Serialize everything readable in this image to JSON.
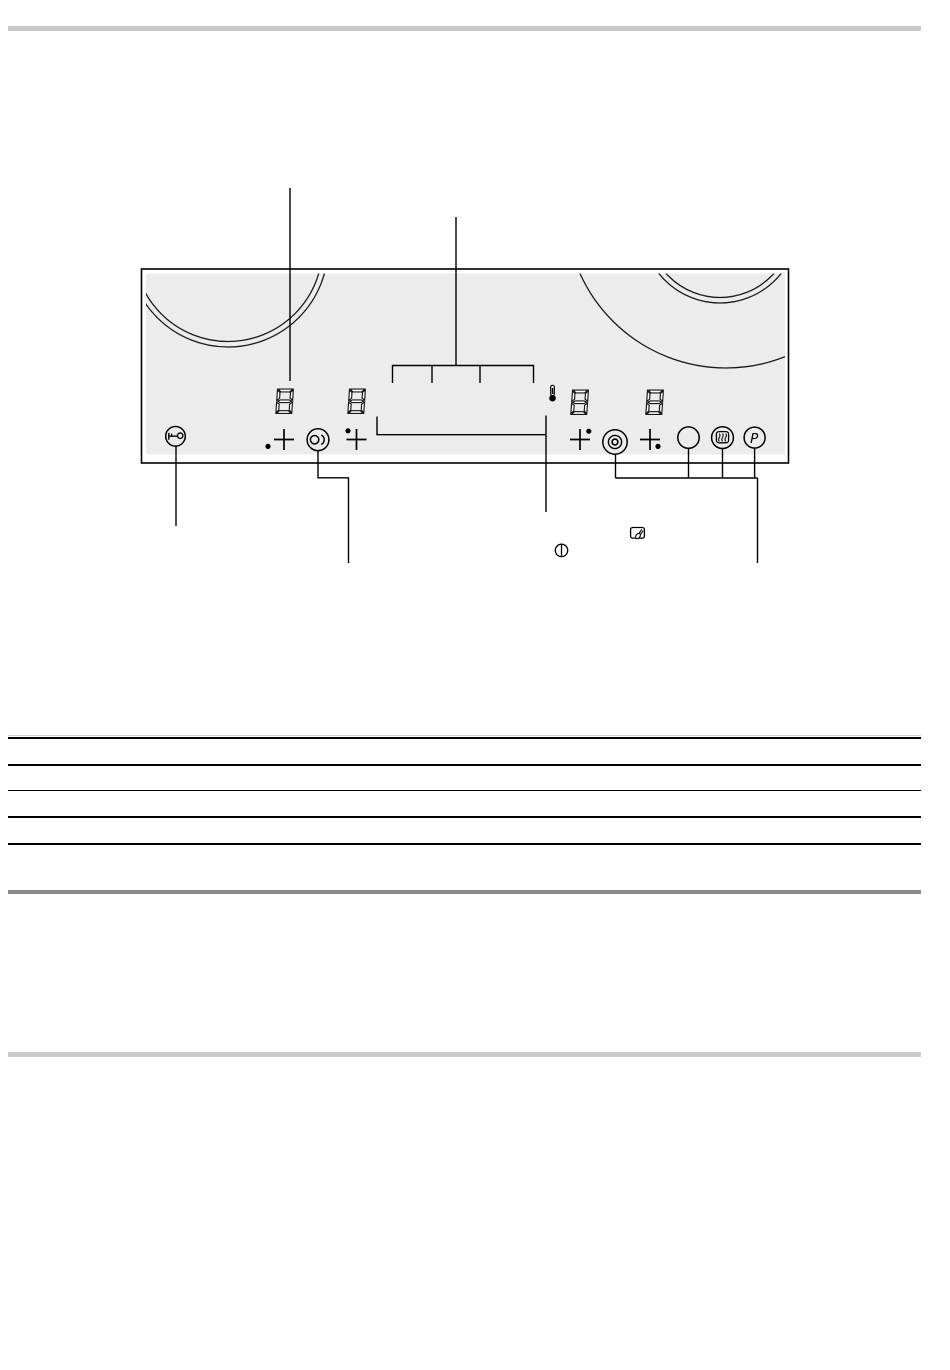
{
  "document": {
    "background": "#ffffff",
    "header_rule_color": "#c9c9c9",
    "footer_rule_color": "#cbcbcb",
    "table_rule_color": "#000000",
    "table_rule_shadow_color": "#cfcfcf",
    "table_footer_rule_color": "#8a8a8a",
    "table_rule_count": 5
  },
  "figure": {
    "panel_fill": "#ececec",
    "panel_border_color": "#000000",
    "line_color": "#000000",
    "power_boost_label": "P",
    "displays": [
      {
        "name": "power-display-1",
        "value": "8"
      },
      {
        "name": "power-display-2",
        "value": "8"
      },
      {
        "name": "power-display-3",
        "value": "8"
      },
      {
        "name": "power-display-4",
        "value": "8"
      }
    ],
    "icons": [
      "key-lock-icon",
      "minus-plus-selector-1",
      "dual-zone-icon",
      "minus-plus-selector-2",
      "timer-bracket",
      "thermometer-icon",
      "minus-plus-selector-3",
      "triple-zone-icon",
      "minus-plus-selector-4",
      "zone-circle-icon",
      "keep-warm-icon",
      "power-boost-icon",
      "standby-power-icon",
      "sensor-touch-icon"
    ]
  }
}
